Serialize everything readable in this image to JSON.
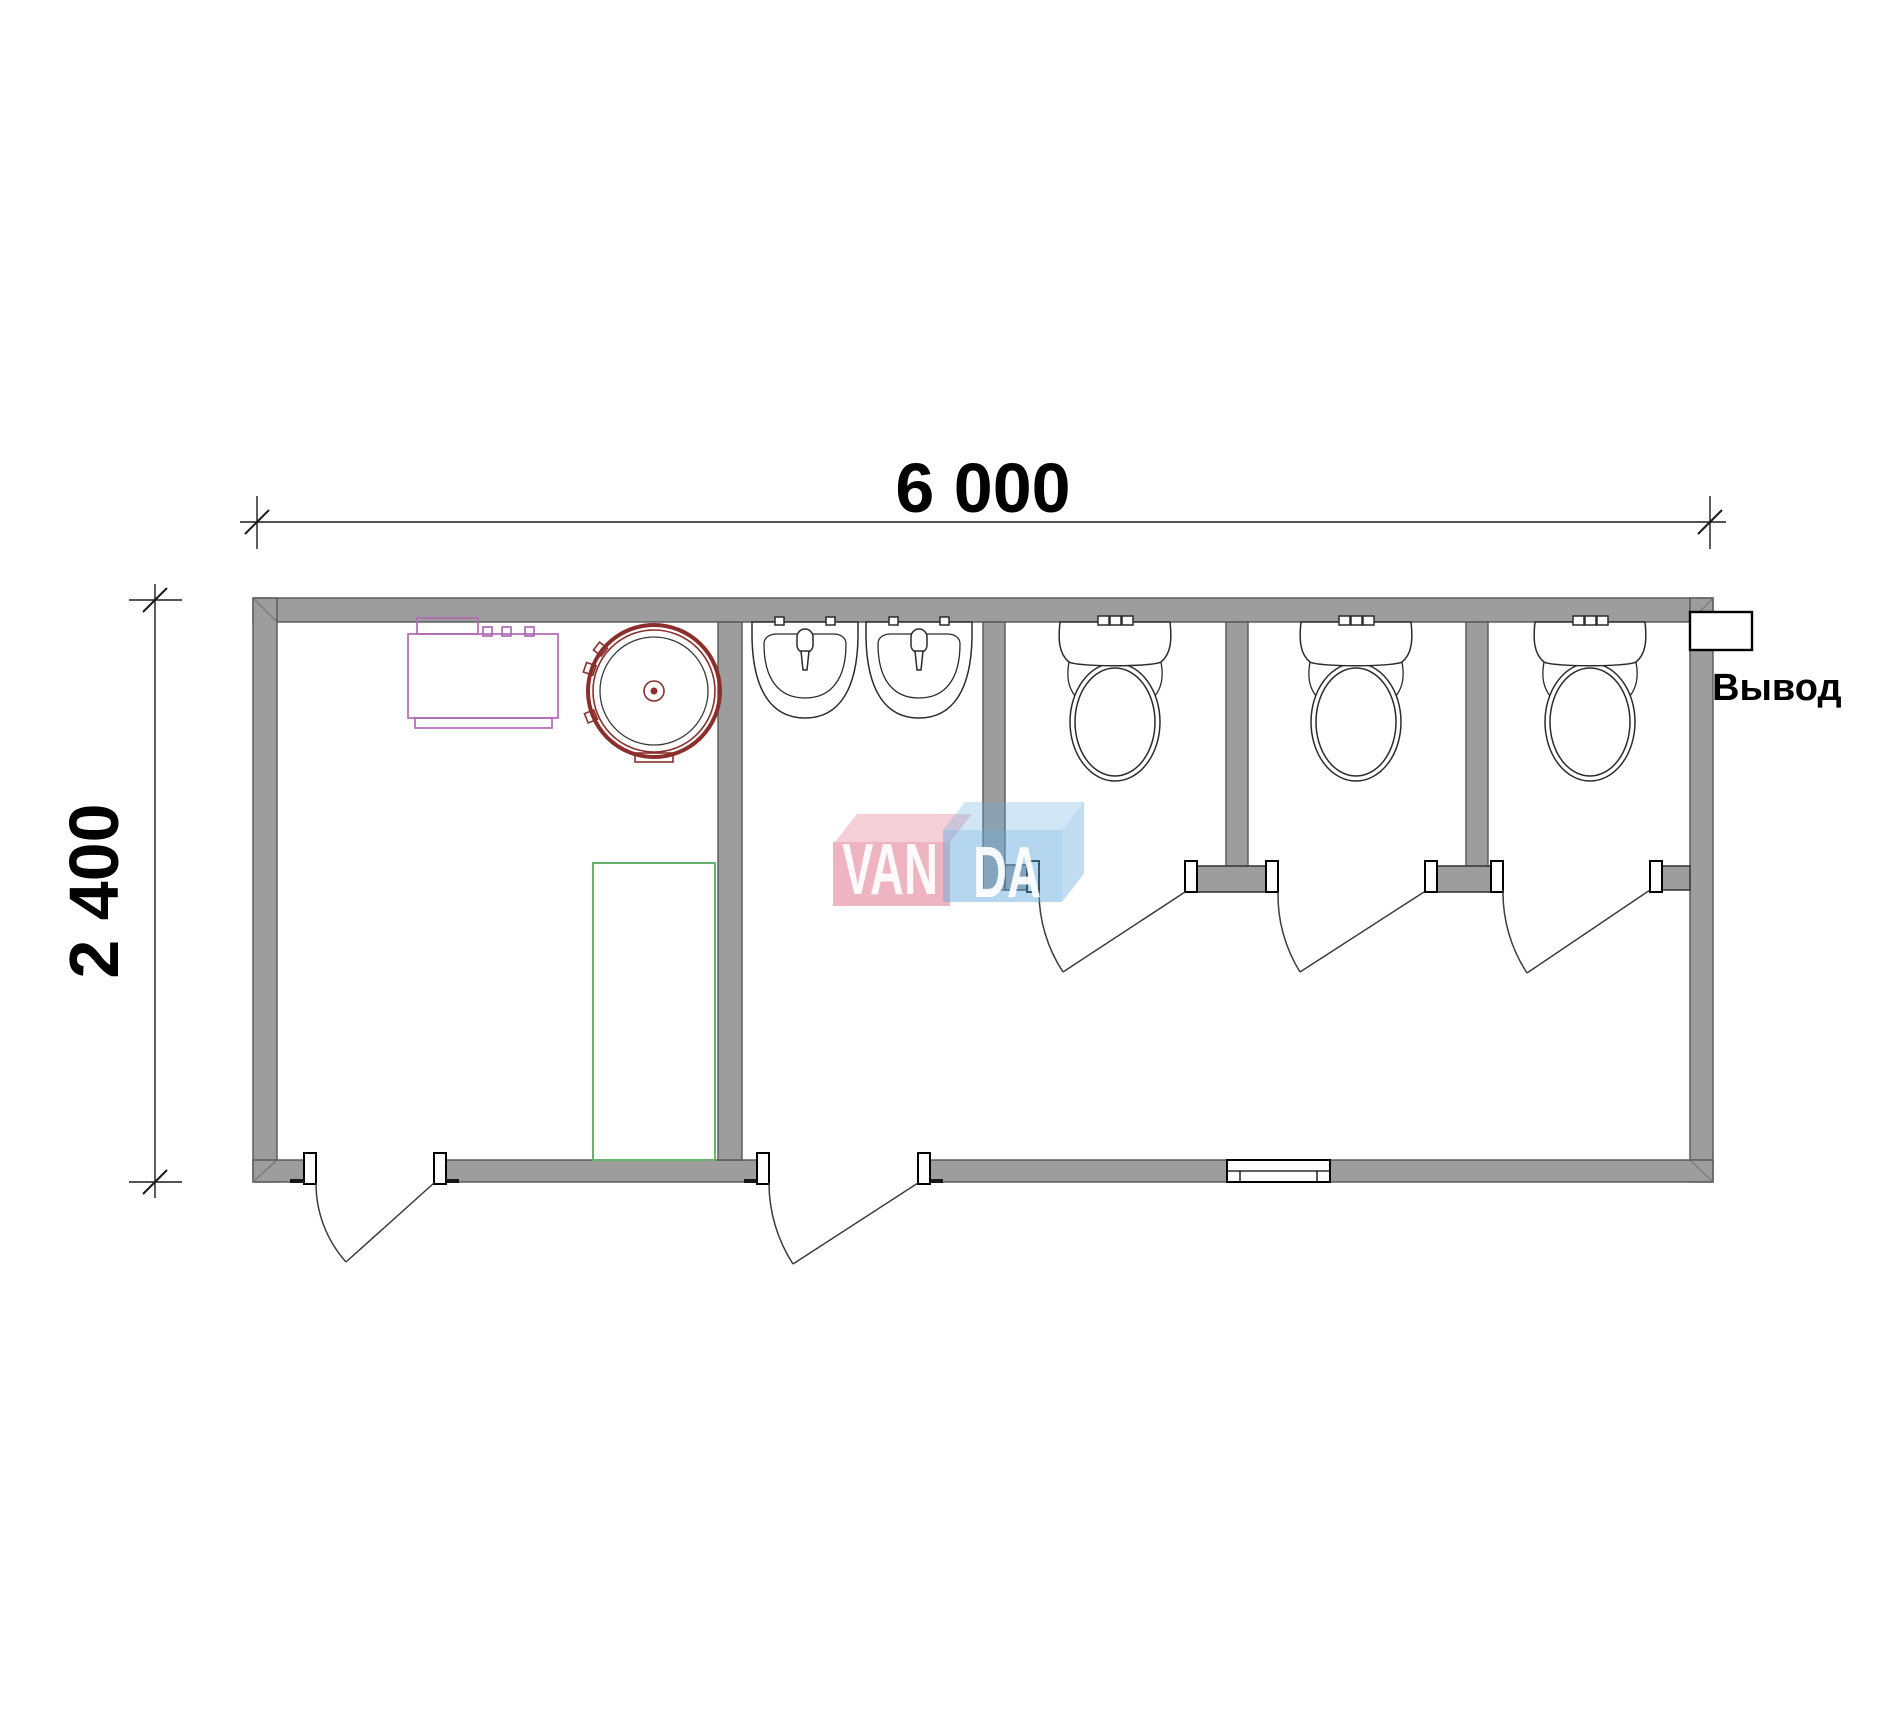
{
  "page": {
    "background": "#ffffff",
    "type": "floor-plan-drawing"
  },
  "drawing": {
    "title": "Sanitary container floor plan",
    "dimensions": {
      "width_label": "6 000",
      "height_label": "2 400"
    },
    "annotations": {
      "outlet_label": "Вывод"
    },
    "watermark": {
      "text_left": "VAN",
      "text_right": "DA",
      "block_left_color": "#e06a84",
      "block_right_color": "#6aaede",
      "letter_color": "#ffffff"
    },
    "colors": {
      "wall_fill": "#9d9d9d",
      "wall_edge": "#565656",
      "drawing_line": "#2b2b2b",
      "heater_red": "#8a2f2b",
      "boiler_purple": "#b06ab3",
      "shower_green": "#67b36b"
    },
    "fixtures": {
      "toilets": 3,
      "washbasins": 2,
      "water_heater": 1,
      "electric_boiler": 1,
      "shower_tray": 1,
      "swing_doors": 5,
      "window_openings": 1
    }
  }
}
